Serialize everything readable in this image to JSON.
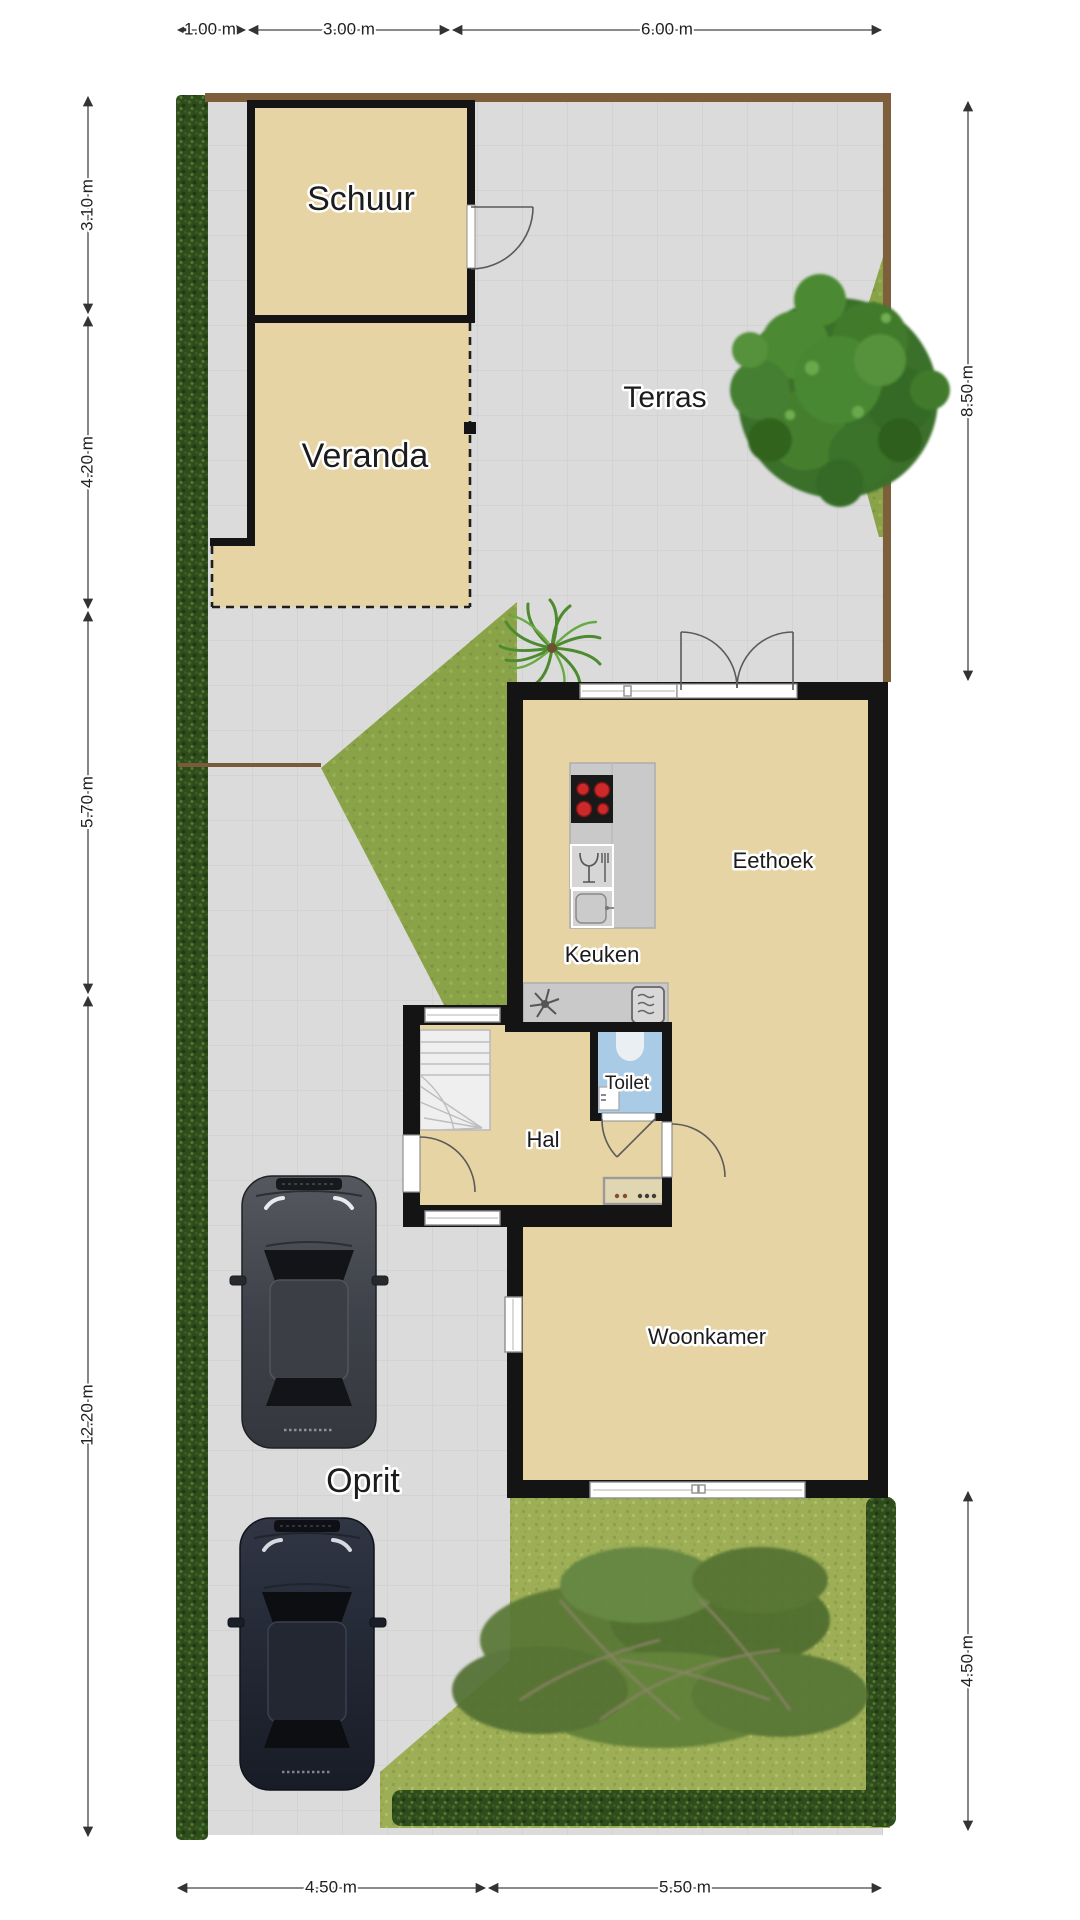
{
  "plan": {
    "rooms": {
      "schuur": "Schuur",
      "veranda": "Veranda",
      "terras": "Terras",
      "eethoek": "Eethoek",
      "keuken": "Keuken",
      "toilet": "Toilet",
      "hal": "Hal",
      "woonkamer": "Woonkamer",
      "oprit": "Oprit"
    },
    "dimensions": {
      "top": [
        "1.00 m",
        "3.00 m",
        "6.00 m"
      ],
      "left": [
        "3.10 m",
        "4.20 m",
        "5.70 m",
        "12.20 m"
      ],
      "right": [
        "8.50 m",
        "4.50 m"
      ],
      "bottom": [
        "4.50 m",
        "5.50 m"
      ]
    },
    "colors": {
      "floor_tan": "#e7d4a4",
      "wall_black": "#141414",
      "paving_gray": "#dbdbdb",
      "hedge_dark_green": "#2f4c1d",
      "grass_green": "#8ba348",
      "garden_green": "#9dae57",
      "toilet_blue": "#a9cbe6",
      "fence_brown": "#7d5f3c",
      "counter_gray": "#c9c9c9",
      "burner_red": "#cc2a2a"
    }
  }
}
